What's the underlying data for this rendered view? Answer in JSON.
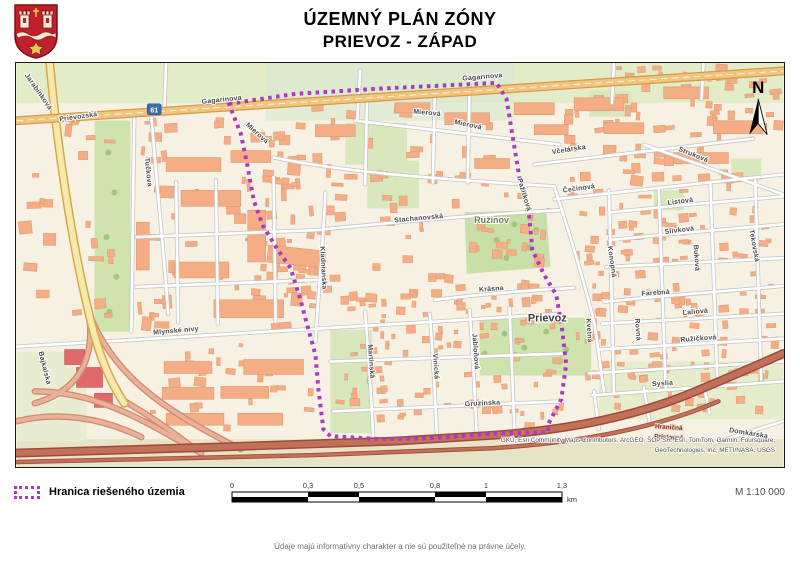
{
  "header": {
    "title_line1": "ÚZEMNÝ PLÁN ZÓNY",
    "title_line2": "PRIEVOZ - ZÁPAD"
  },
  "map": {
    "north_label": "N",
    "route_shield": "61",
    "place_labels": [
      {
        "t": "Prievoz",
        "x": 533,
        "y": 260,
        "r": 0,
        "cls": "place-lbl"
      },
      {
        "t": "Ružinov",
        "x": 477,
        "y": 161,
        "r": 0,
        "cls": "place-lbl2"
      }
    ],
    "street_labels": [
      {
        "t": "Prievozská",
        "x": 62,
        "y": 56,
        "r": -8
      },
      {
        "t": "Gagarinova",
        "x": 206,
        "y": 39,
        "r": -6
      },
      {
        "t": "Gagarinova",
        "x": 468,
        "y": 16,
        "r": -5
      },
      {
        "t": "Mierová",
        "x": 240,
        "y": 72,
        "r": 42
      },
      {
        "t": "Mierová",
        "x": 412,
        "y": 52,
        "r": 5
      },
      {
        "t": "Mierová",
        "x": 453,
        "y": 64,
        "r": 12
      },
      {
        "t": "Tučkova",
        "x": 130,
        "y": 110,
        "r": 84
      },
      {
        "t": "Jarabinková",
        "x": 20,
        "y": 30,
        "r": 55
      },
      {
        "t": "Mlynské nivy",
        "x": 160,
        "y": 271,
        "r": -5
      },
      {
        "t": "Bajkalská",
        "x": 26,
        "y": 307,
        "r": 76
      },
      {
        "t": "Stachanovská",
        "x": 404,
        "y": 158,
        "r": -5
      },
      {
        "t": "Kladnianska",
        "x": 306,
        "y": 206,
        "r": 87
      },
      {
        "t": "Krásna",
        "x": 477,
        "y": 229,
        "r": -4
      },
      {
        "t": "Gruzínska",
        "x": 468,
        "y": 344,
        "r": -3
      },
      {
        "t": "Martinská",
        "x": 354,
        "y": 300,
        "r": 86
      },
      {
        "t": "Vinická",
        "x": 419,
        "y": 305,
        "r": 86
      },
      {
        "t": "Jabloňová",
        "x": 459,
        "y": 290,
        "r": 86
      },
      {
        "t": "Pažítková",
        "x": 508,
        "y": 133,
        "r": 73
      },
      {
        "t": "Včelárska",
        "x": 555,
        "y": 89,
        "r": -9
      },
      {
        "t": "Struková",
        "x": 679,
        "y": 94,
        "r": 22
      },
      {
        "t": "Čečinová",
        "x": 565,
        "y": 128,
        "r": -8
      },
      {
        "t": "Listová",
        "x": 667,
        "y": 141,
        "r": -7
      },
      {
        "t": "Slivková",
        "x": 666,
        "y": 170,
        "r": -7
      },
      {
        "t": "Konopná",
        "x": 596,
        "y": 200,
        "r": 82
      },
      {
        "t": "Buková",
        "x": 681,
        "y": 196,
        "r": 86
      },
      {
        "t": "Tekovská",
        "x": 739,
        "y": 184,
        "r": 80
      },
      {
        "t": "Farebná",
        "x": 642,
        "y": 233,
        "r": -4
      },
      {
        "t": "Ľaliová",
        "x": 682,
        "y": 252,
        "r": -5
      },
      {
        "t": "Ružičková",
        "x": 685,
        "y": 279,
        "r": -4
      },
      {
        "t": "Kvetná",
        "x": 573,
        "y": 269,
        "r": 86
      },
      {
        "t": "Rovná",
        "x": 622,
        "y": 268,
        "r": 86
      },
      {
        "t": "Syslia",
        "x": 649,
        "y": 324,
        "r": -4
      },
      {
        "t": "Domkárska",
        "x": 735,
        "y": 374,
        "r": 9
      }
    ],
    "road_labels": [
      {
        "t": "Hraničná",
        "x": 655,
        "y": 368,
        "r": 4
      },
      {
        "t": "Prístavná",
        "x": 655,
        "y": 378,
        "r": 3
      }
    ],
    "attribution_line1": "GKÚ, Esri Community Maps Contributors, ArcGEO, ŠOP SR, Esri, TomTom, Garmin, Foursquare,",
    "attribution_line2": "GeoTechnologies, Inc, METI/NASA, USGS"
  },
  "legend": {
    "boundary_label": "Hranica riešeného územia"
  },
  "scalebar": {
    "ticks": [
      "0",
      "0,3",
      "0,5",
      "0,8",
      "1",
      "1,3"
    ],
    "cumulative_px": [
      0,
      76,
      127,
      203,
      254,
      330
    ],
    "unit": "km"
  },
  "scale_text": "M 1:10 000",
  "disclaimer": "Údaje majú informatívny charakter a nie sú použiteľné na právne účely.",
  "colors": {
    "boundary": "#AC39C4",
    "shield_red": "#c0202a",
    "building": "#f4ad85",
    "main_road": "#f1c57e",
    "highway": "#c1705a"
  }
}
